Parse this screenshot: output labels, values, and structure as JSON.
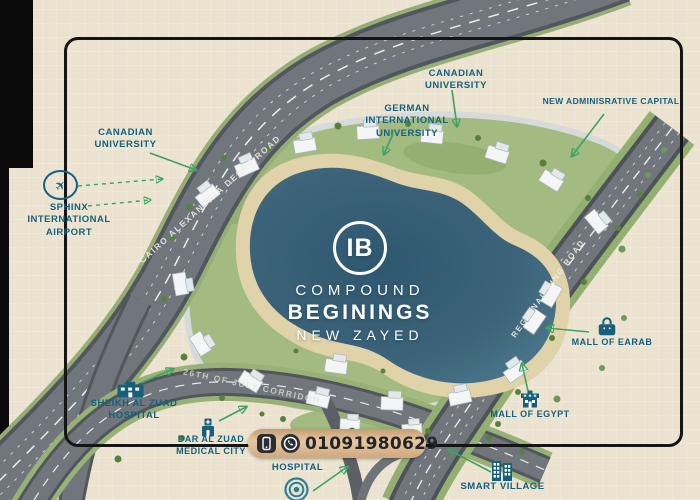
{
  "brand": {
    "monogram": "IB",
    "line1": "COMPOUND",
    "line2": "BEGININGS",
    "line3": "NEW ZAYED"
  },
  "contact": {
    "phone": "01091980629"
  },
  "roads": {
    "cairo_alexandria_desert_road": "CAIRO ALEXANDRIA DESRT ROAD",
    "regional_ring_road": "REGIONAL RING ROAD",
    "july_corridor": "26TH OF JULY CORRIDOR"
  },
  "landmarks": {
    "canadian_university_west": {
      "line1": "CANADIAN",
      "line2": "UNIVERSITY"
    },
    "sphinx_airport": {
      "line1": "SPHINX",
      "line2": "INTERNATIONAL",
      "line3": "AIRPORT"
    },
    "canadian_university_north": {
      "line1": "CANADIAN",
      "line2": "UNIVERSITY"
    },
    "german_university": {
      "line1": "GERMAN",
      "line2": "INTERNATIONAL",
      "line3": "UNIVERSITY"
    },
    "new_administrative_capital": {
      "line1": "NEW ADMINISRATIVE CAPITAL"
    },
    "mall_of_earab": {
      "line1": "MALL OF EARAB"
    },
    "mall_of_egypt": {
      "line1": "MALL OF EGYPT"
    },
    "sheikh_al_zuad_hospital": {
      "line1": "SHEIKH AL ZUAD",
      "line2": "HOSPITAL"
    },
    "dar_al_zuad_medical_city": {
      "line1": "DAR AL ZUAD",
      "line2": "MEDICAL CITY"
    },
    "dar_al_zued_hospital": {
      "line1": "DAR AL ZUED",
      "line2": "HOSPITAL"
    },
    "smart_village": {
      "line1": "SMART VILLAGE"
    }
  },
  "colors": {
    "label_teal": "#15607c",
    "arrow_green": "#3da263",
    "lake": "#3c6379",
    "sand": "#e0d2a9",
    "greenery": "#a3bb80",
    "road": "#70767c",
    "pill": "#e6c89f",
    "background": "#ebe3cf"
  }
}
